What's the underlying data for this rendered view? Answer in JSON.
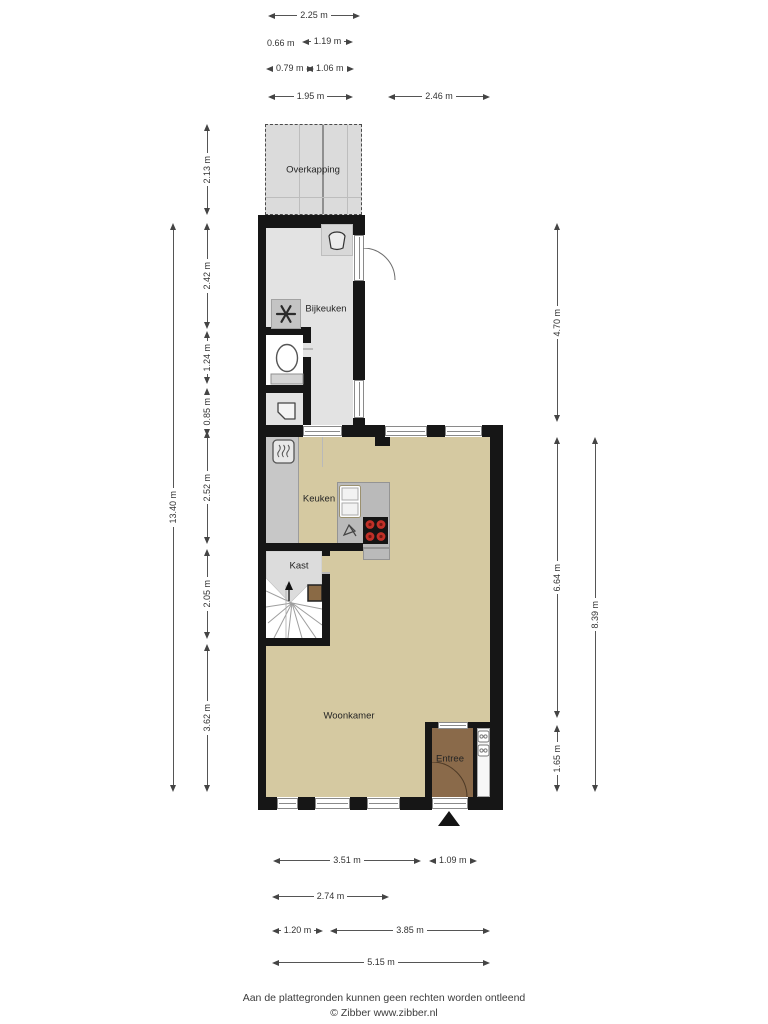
{
  "floorplan": {
    "rooms": {
      "overkapping": "Overkapping",
      "bijkeuken": "Bijkeuken",
      "keuken": "Keuken",
      "kast": "Kast",
      "woonkamer": "Woonkamer",
      "entree": "Entree"
    },
    "dimensions": {
      "top": [
        "2.25 m",
        "0.66 m",
        "1.19 m",
        "0.79 m",
        "1.06 m",
        "1.95 m",
        "2.46 m"
      ],
      "left": [
        "2.13 m",
        "2.42 m",
        "1.24 m",
        "0.85 m",
        "2.52 m",
        "2.05 m",
        "3.62 m",
        "13.40 m"
      ],
      "right": [
        "4.70 m",
        "6.64 m",
        "1.65 m",
        "8.39 m"
      ],
      "bottom": [
        "3.51 m",
        "1.09 m",
        "2.74 m",
        "1.20 m",
        "3.85 m",
        "5.15 m"
      ]
    },
    "icons": {
      "washbasin-icon": "basin glyph",
      "extractor-fan-icon": "6-blade fan",
      "toilet-icon": "toilet bowl with cistern",
      "corner-sink-icon": "small corner hand basin",
      "boiler-icon": "boiler with heat squiggles",
      "double-sink-icon": "double sink unit",
      "faucet-icon": "tap glyph",
      "cooktop-icon": "hob with 4 red burners",
      "stairs-icon": "winder staircase with up arrow",
      "door-arc-icon": "door swing arc",
      "entrance-marker-icon": "black entrance triangle",
      "meter-cupboard-icon": "two meter boxes"
    },
    "colors": {
      "wall": "#161616",
      "floor_main": "#d5c9a1",
      "floor_utility": "#e3e3e3",
      "floor_overkapping": "#dbdbdb",
      "floor_kast": "#dcdcdc",
      "toilet_floor": "#ffffff",
      "counter": "#c7c7c7",
      "island": "#bababa",
      "entree_floor": "#8a6a4a",
      "burner": "#c03028",
      "meterkast": "#f7f7f7"
    }
  },
  "footer": {
    "disclaimer": "Aan de plattegronden kunnen geen rechten worden ontleend",
    "copyright": "© Zibber www.zibber.nl"
  }
}
